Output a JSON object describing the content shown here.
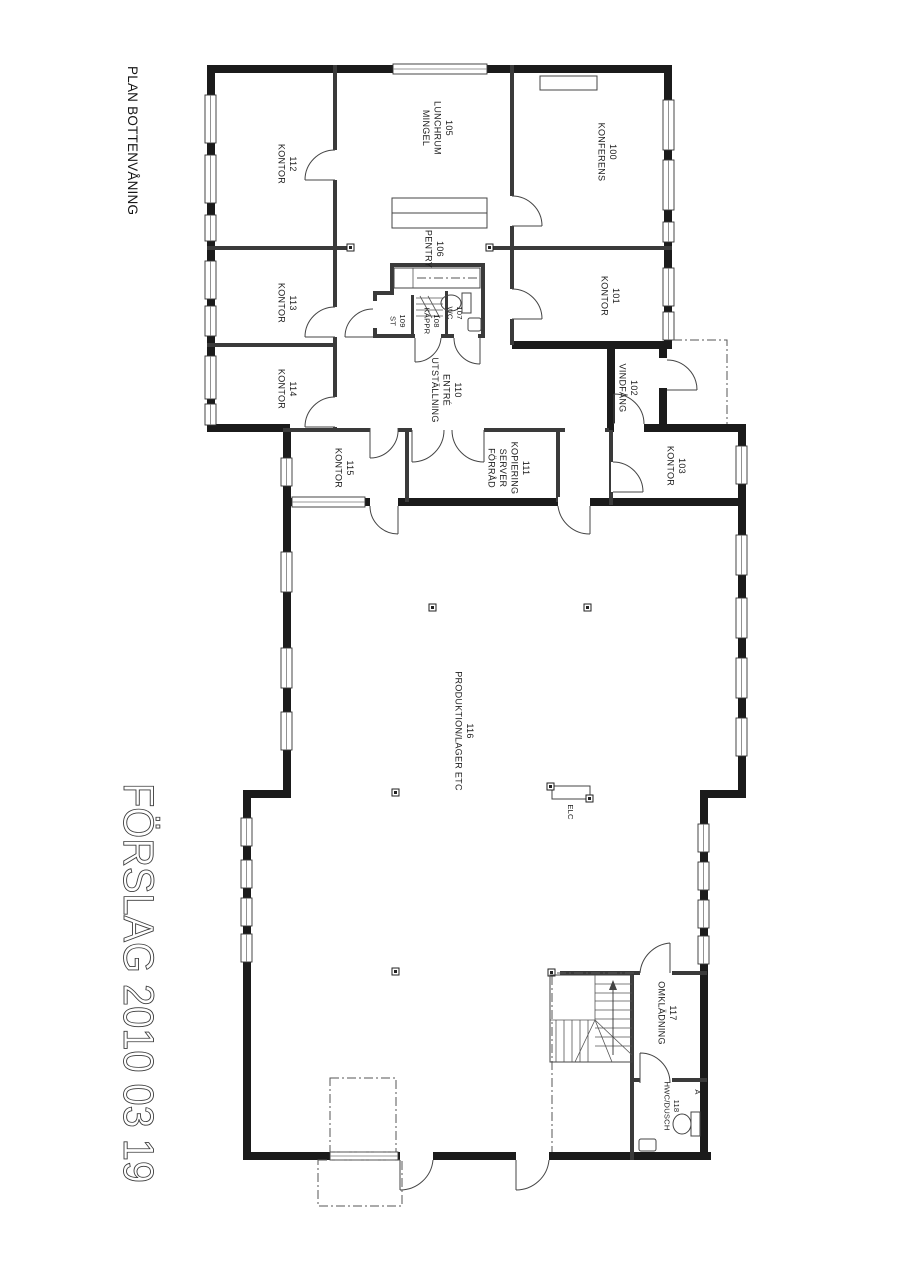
{
  "meta": {
    "title": "PLAN BOTTENVÅNING",
    "stamp": "FÖRSLAG 2010 03 19"
  },
  "rooms": {
    "100": {
      "label": "100\nKONFERENS"
    },
    "101": {
      "label": "101\nKONTOR"
    },
    "102": {
      "label": "102\nVINDFÅNG"
    },
    "103": {
      "label": "103\nKONTOR"
    },
    "105": {
      "label": "105\nLUNCHRUM\nMINGEL"
    },
    "106": {
      "label": "106\nPENTRY"
    },
    "107": {
      "label": "107\nWC"
    },
    "108": {
      "label": "108\nKAPPR"
    },
    "109": {
      "label": "109\nST"
    },
    "110": {
      "label": "110\nENTRÉ\nUTSTÄLLNING"
    },
    "111": {
      "label": "111\nKOPIERING\nSERVER\nFÖRRÅD"
    },
    "112": {
      "label": "112\nKONTOR"
    },
    "113": {
      "label": "113\nKONTOR"
    },
    "114": {
      "label": "114\nKONTOR"
    },
    "115": {
      "label": "115\nKONTOR"
    },
    "116": {
      "label": "116\nPRODUKTION/LAGER ETC"
    },
    "117": {
      "label": "117\nOMKLÄDNING"
    },
    "118": {
      "label": "118\nHWC/DUSCH"
    }
  },
  "markers": {
    "elc": "ELC",
    "section": "A"
  }
}
